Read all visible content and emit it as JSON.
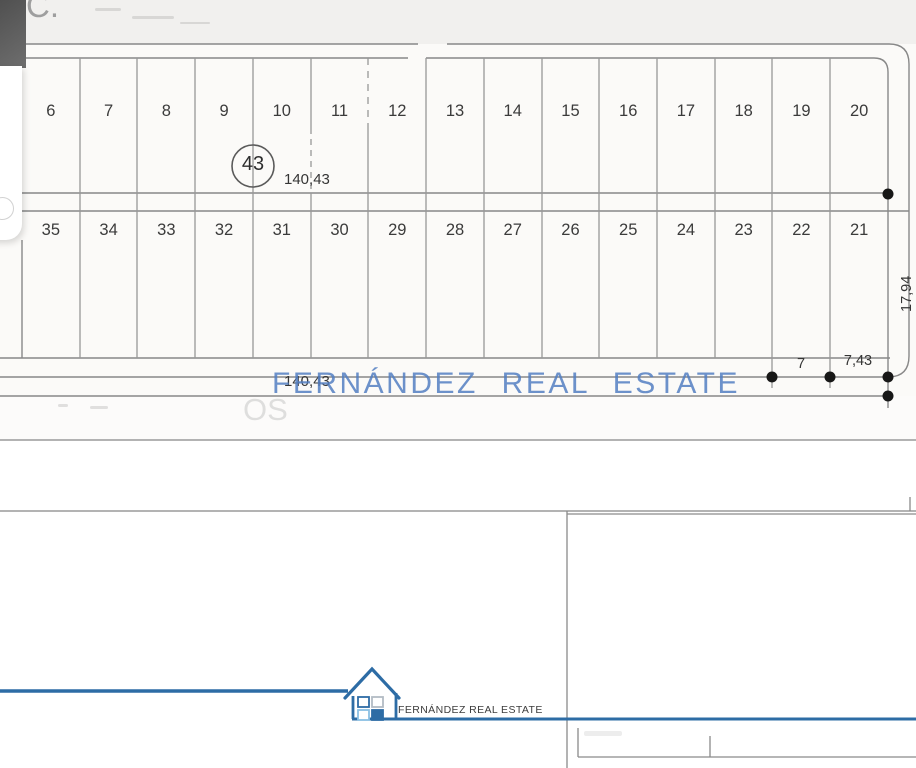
{
  "corner_note": "C.",
  "plan": {
    "row1_lots": [
      "6",
      "7",
      "8",
      "9",
      "10",
      "11",
      "12",
      "13",
      "14",
      "15",
      "16",
      "17",
      "18",
      "19",
      "20"
    ],
    "row2_lots": [
      "35",
      "34",
      "33",
      "32",
      "31",
      "30",
      "29",
      "28",
      "27",
      "26",
      "25",
      "24",
      "23",
      "22",
      "21"
    ],
    "circle_label": "43",
    "dim_top": "140,43",
    "dim_bottom": "140,43",
    "dim_right": "17,94",
    "dim_seg1": "7",
    "dim_seg2": "7,43"
  },
  "watermark": {
    "text": "FERNÁNDEZ REAL ESTATE",
    "color": "#527ec2"
  },
  "erased_text": "OS",
  "footer": {
    "brand_text": "FERNÁNDEZ REAL ESTATE",
    "accent_color": "#2d6ca5"
  },
  "icons": {
    "house_logo": "house-with-windows-icon"
  }
}
